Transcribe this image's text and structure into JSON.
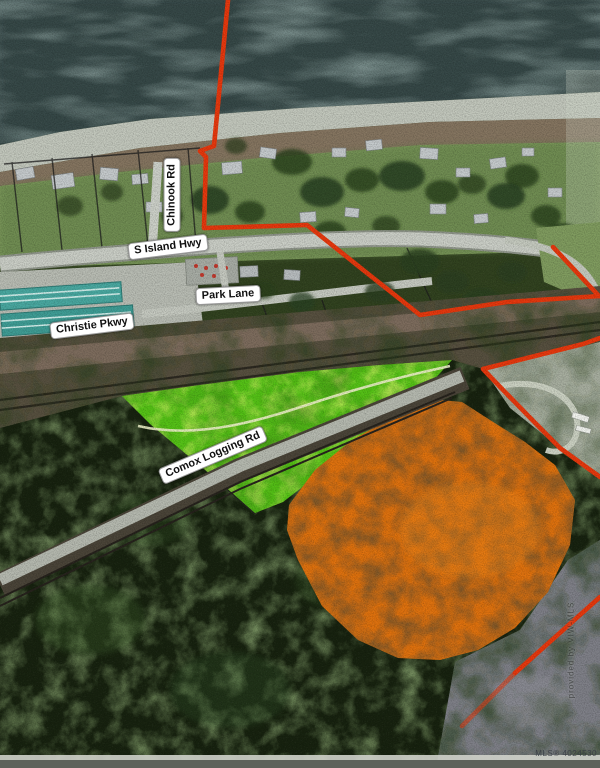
{
  "map": {
    "description": "Aerial real-estate parcel map with red lot boundaries and green/orange highlighted parcels",
    "roads": {
      "chinook": "Chinook Rd",
      "s_island_hwy": "S Island Hwy",
      "park_lane": "Park Lane",
      "christie_pkwy": "Christie Pkwy",
      "comox_logging": "Comox Logging Rd"
    },
    "watermark": {
      "vertical": "provided by VIW-MLS",
      "mls_number": "MLS® 4024530"
    },
    "colors": {
      "boundary_red": "#e8380d",
      "highlight_green": "#55c316",
      "highlight_orange": "#e0720e",
      "water": "#3d4f4e",
      "shore": "#c3c8bd",
      "road": "#cbcfc7",
      "forest_dark": "#17220f"
    }
  }
}
